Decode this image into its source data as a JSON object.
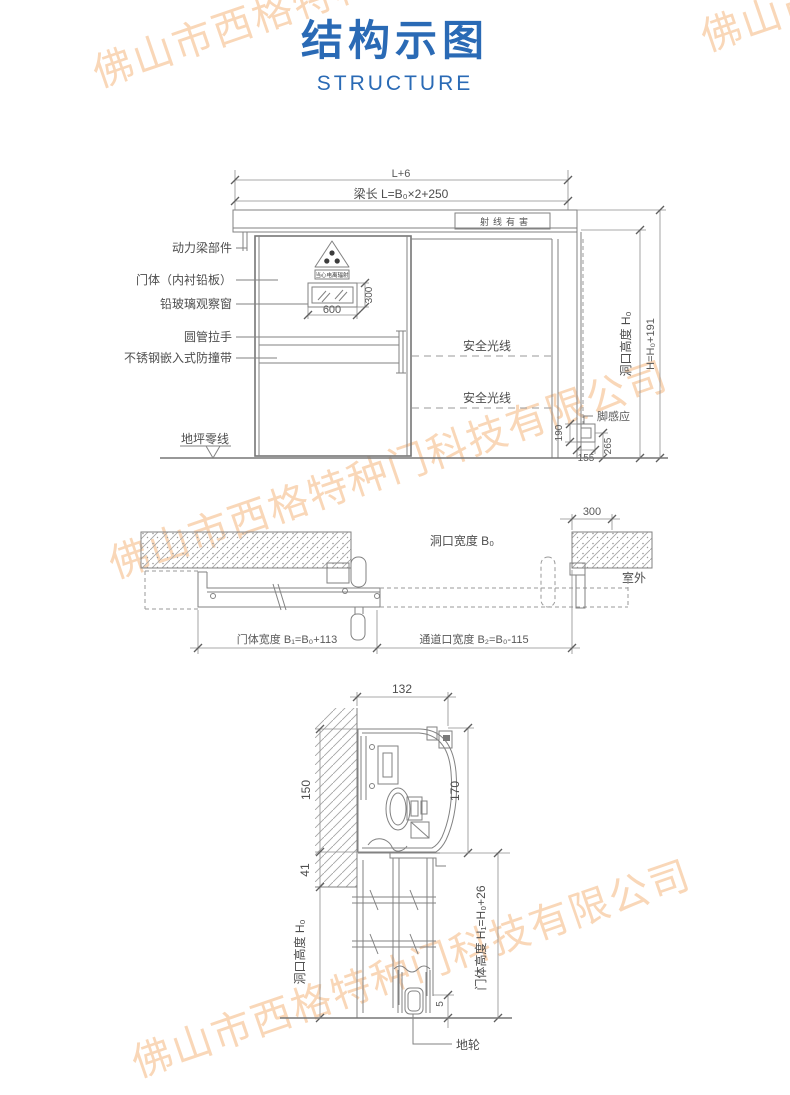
{
  "header": {
    "title": "结构示图",
    "subtitle": "STRUCTURE"
  },
  "watermark": {
    "text": "佛山市西格特种门科技有限公司"
  },
  "colors": {
    "accent_blue": "#2a6ab5",
    "line_gray": "#828282",
    "watermark_peach": "#f6c79d"
  },
  "front_view": {
    "dim_overall_width": "L+6",
    "dim_beam_length": "梁长 L=B₀×2+250",
    "beam_warning_sign": "射线有害",
    "radiation_sign_caption": "当心电离辐射",
    "label_power_beam": "动力梁部件",
    "label_door_body": "门体（内衬铅板）",
    "label_lead_glass_window": "铅玻璃观察窗",
    "label_tube_handle": "圆管拉手",
    "label_bumper_strip": "不锈钢嵌入式防撞带",
    "label_floor_zero_line": "地坪零线",
    "label_safety_beam_upper": "安全光线",
    "label_safety_beam_lower": "安全光线",
    "label_foot_sensor": "脚感应",
    "dim_window_width": "600",
    "dim_window_height": "300",
    "dim_sensor_height": "190",
    "dim_sensor_width": "155",
    "dim_sensor_offset": "265",
    "dim_opening_height": "洞口高度 H₀",
    "dim_overall_height": "H=H₀+191"
  },
  "plan_view": {
    "dim_opening_width": "洞口宽度 B₀",
    "dim_wall_overlap": "300",
    "label_outdoor": "室外",
    "dim_door_width": "门体宽度 B₁=B₀+113",
    "dim_passage_width": "通道口宽度 B₂=B₀-115"
  },
  "section_view": {
    "dim_track_depth": "132",
    "dim_hood_height": "150",
    "dim_unit_height": "170",
    "dim_beam_clearance": "41",
    "dim_opening_height": "洞口高度 H₀",
    "dim_door_height": "门体高度 H₁=H₀+26",
    "dim_wheel_clearance": "5",
    "label_ground_wheel": "地轮"
  }
}
